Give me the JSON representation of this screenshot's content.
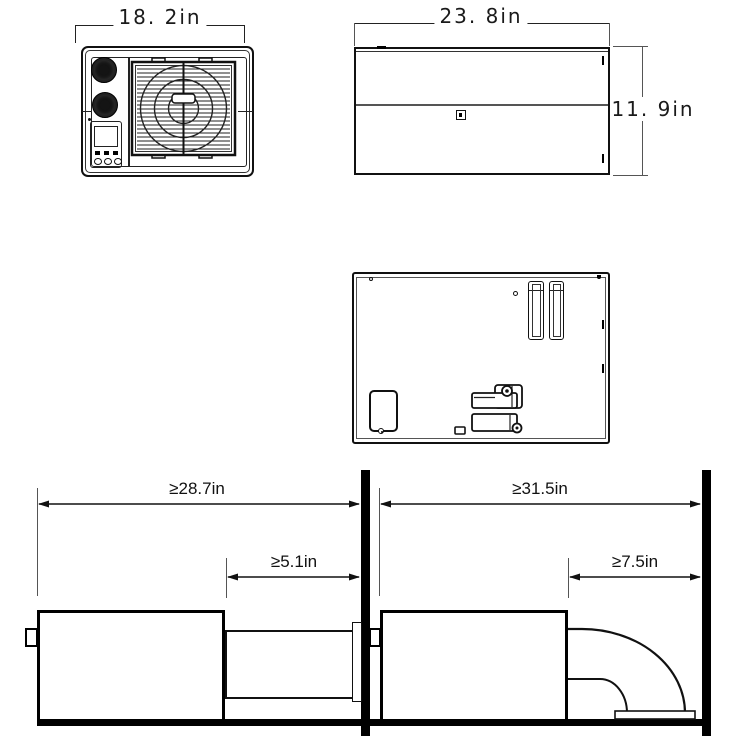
{
  "page": {
    "description": "Technical dimension drawing of a window air conditioner: front, top and back views plus two installation clearance diagrams",
    "background": "#ffffff",
    "line_color": "#1a1a1a",
    "units": "in"
  },
  "front_view": {
    "width_label": "18. 2in",
    "width_value": 18.2
  },
  "top_view": {
    "width_label": "23. 8in",
    "width_value": 23.8,
    "height_label": "11. 9in",
    "height_value": 11.9
  },
  "install_straight_duct": {
    "room_clearance_label": "≥28.7in",
    "room_clearance_value": 28.7,
    "duct_clearance_label": "≥5.1in",
    "duct_clearance_value": 5.1
  },
  "install_down_duct": {
    "room_clearance_label": "≥31.5in",
    "room_clearance_value": 31.5,
    "duct_clearance_label": "≥7.5in",
    "duct_clearance_value": 7.5
  }
}
